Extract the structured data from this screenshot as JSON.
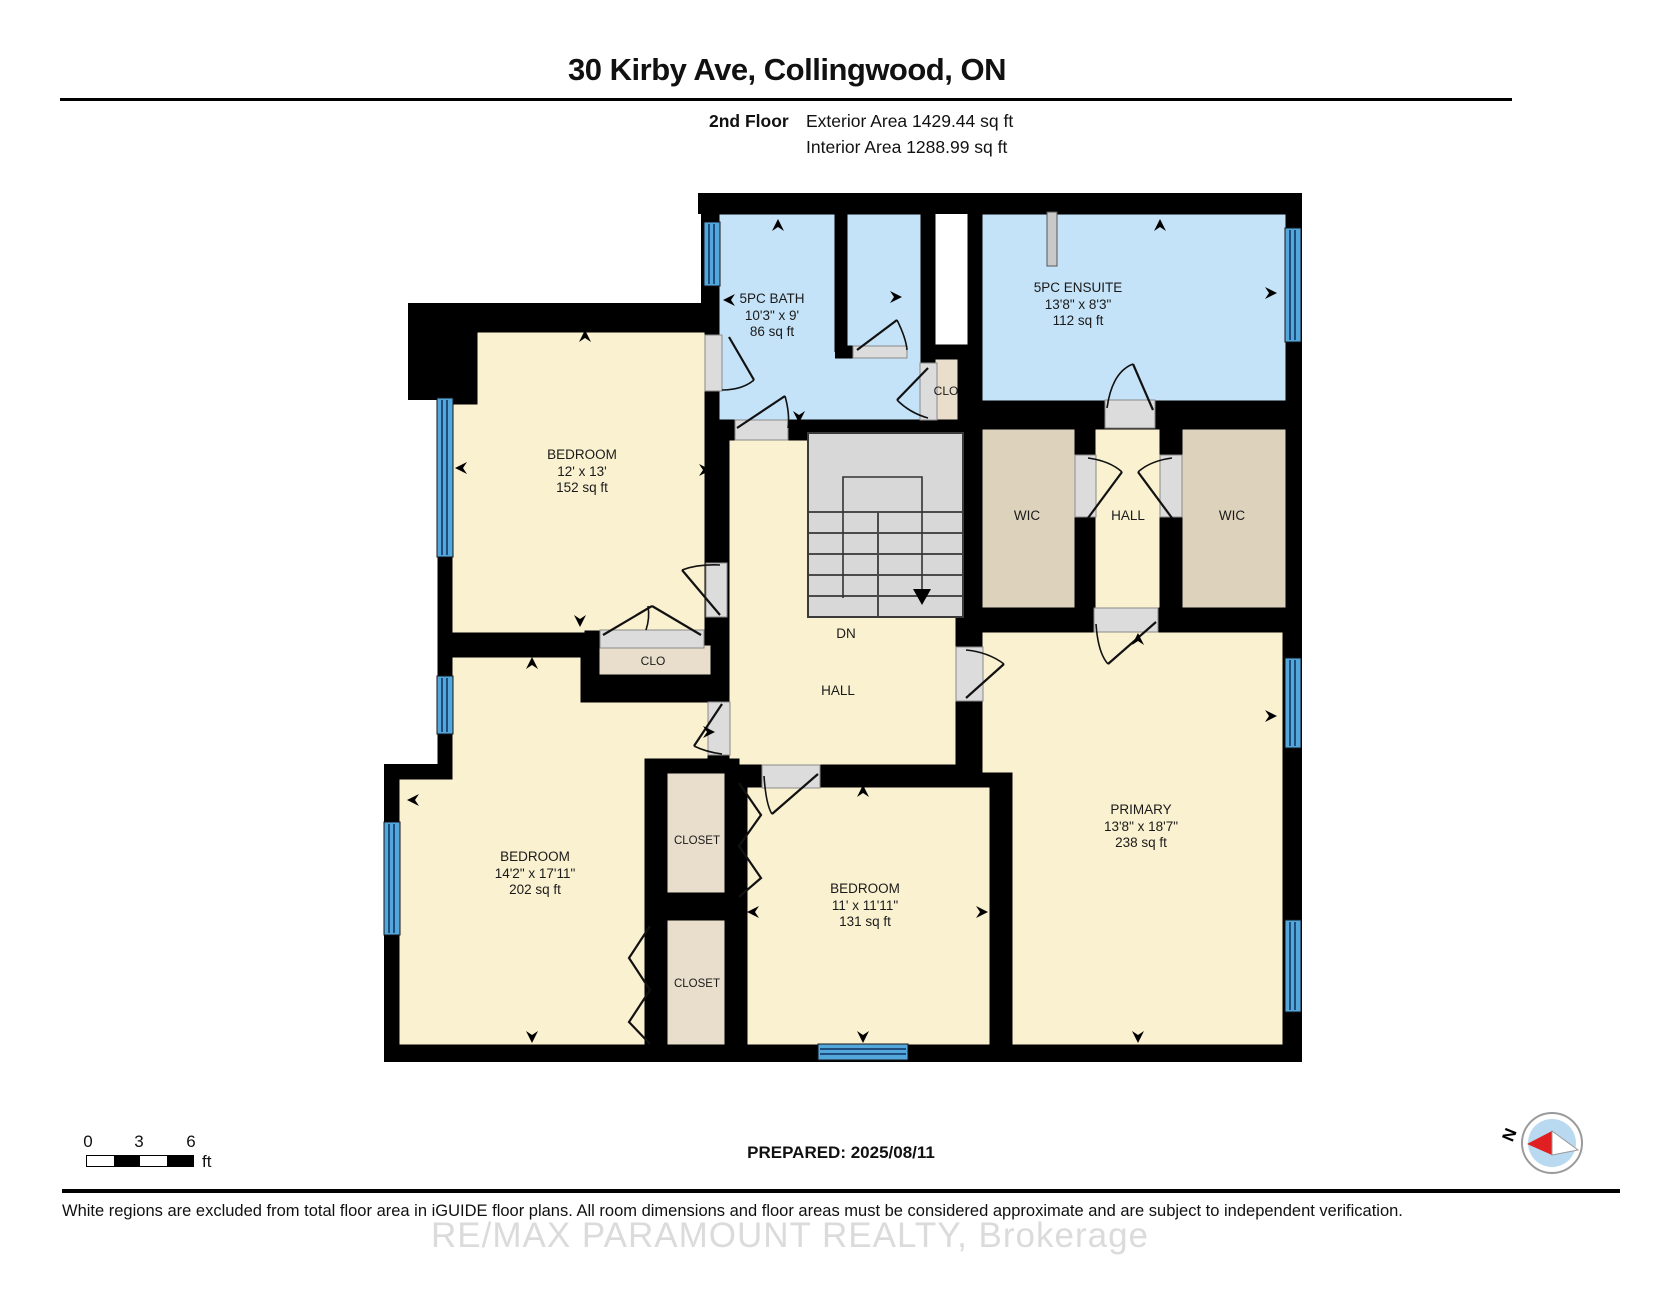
{
  "header": {
    "title": "30 Kirby Ave, Collingwood, ON",
    "floor_label": "2nd Floor",
    "exterior_area": "Exterior Area 1429.44 sq ft",
    "interior_area": "Interior Area 1288.99 sq ft"
  },
  "rooms": {
    "bath": {
      "name": "5PC BATH",
      "dims": "10'3\" x 9'",
      "area": "86 sq ft"
    },
    "ensuite": {
      "name": "5PC ENSUITE",
      "dims": "13'8\" x 8'3\"",
      "area": "112 sq ft"
    },
    "bedroom_top_left": {
      "name": "BEDROOM",
      "dims": "12' x 13'",
      "area": "152 sq ft"
    },
    "bedroom_bottom_left": {
      "name": "BEDROOM",
      "dims": "14'2\" x 17'11\"",
      "area": "202 sq ft"
    },
    "bedroom_bottom_middle": {
      "name": "BEDROOM",
      "dims": "11' x 11'11\"",
      "area": "131 sq ft"
    },
    "primary": {
      "name": "PRIMARY",
      "dims": "13'8\" x 18'7\"",
      "area": "238 sq ft"
    },
    "wic_left": {
      "name": "WIC"
    },
    "wic_right": {
      "name": "WIC"
    },
    "hall_upper": {
      "name": "HALL"
    },
    "hall_main": {
      "name": "HALL"
    },
    "clo_bath": {
      "name": "CLO"
    },
    "clo_bedroom": {
      "name": "CLO"
    },
    "closet_upper": {
      "name": "CLOSET"
    },
    "closet_lower": {
      "name": "CLOSET"
    },
    "stairs": {
      "label": "DN"
    }
  },
  "scale_bar": {
    "t0": "0",
    "t1": "3",
    "t2": "6",
    "unit": "ft"
  },
  "compass": {
    "label": "N"
  },
  "footer": {
    "prepared": "PREPARED: 2025/08/11",
    "disclaimer": "White regions are excluded from total floor area in iGUIDE floor plans. All room dimensions and floor areas must be considered approximate and are subject to independent verification.",
    "watermark": "RE/MAX PARAMOUNT REALTY, Brokerage"
  },
  "colors": {
    "room_fill": "#FAF1D0",
    "wet_room_fill": "#C5E3F8",
    "closet_fill": "#E8DECB",
    "wic_fill": "#DDD2BC",
    "stairs_fill": "#D8D8D8",
    "window_fill": "#54A7DB",
    "wall": "#000000"
  }
}
